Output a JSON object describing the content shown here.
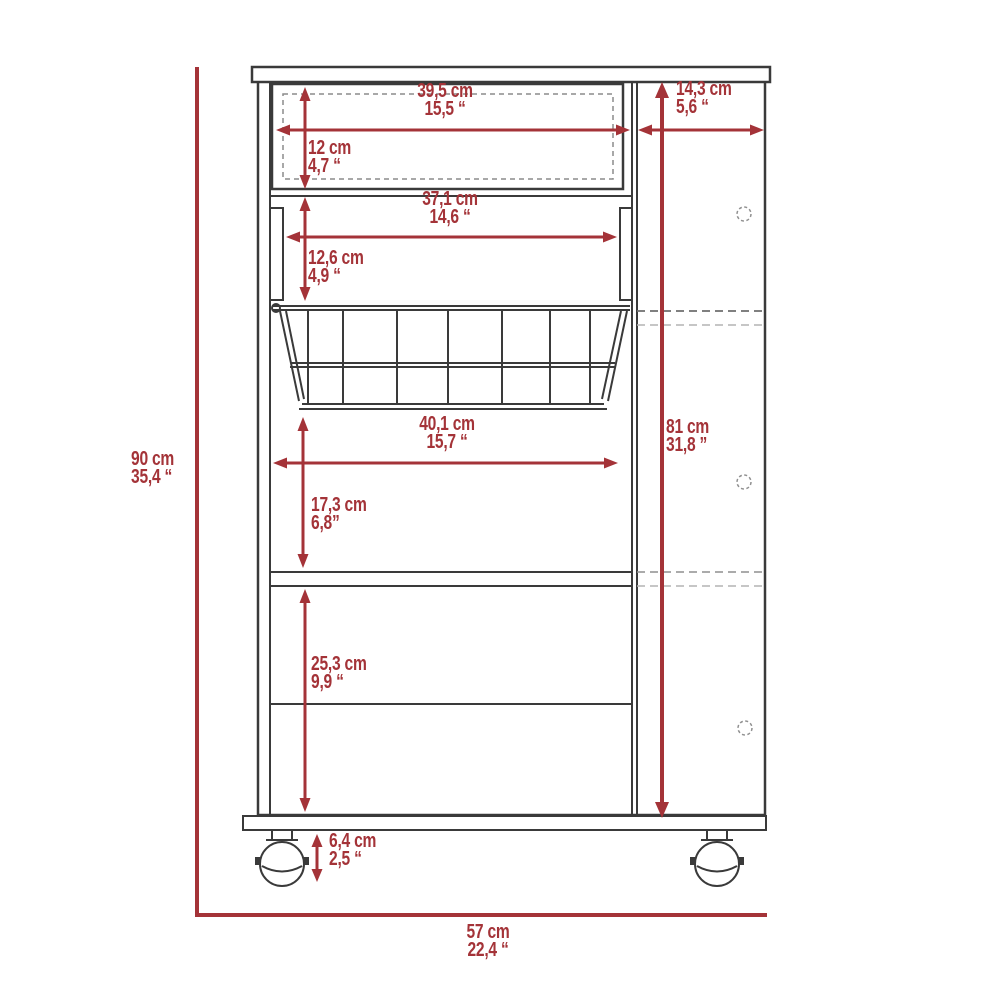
{
  "diagram": {
    "type": "furniture dimension drawing",
    "subject": "cabinet front elevation with pull-out wire basket, drawer, shelves and ball casters",
    "units": [
      "cm",
      "inches"
    ]
  },
  "dimensions": {
    "top_drawer_width": {
      "metric": "39,5 cm",
      "imperial": "15,5 “"
    },
    "top_drawer_height": {
      "metric": "12 cm",
      "imperial": "4,7 “"
    },
    "right_panel_width": {
      "metric": "14,3 cm",
      "imperial": "5,6 “"
    },
    "basket_opening_width": {
      "metric": "37,1 cm",
      "imperial": "14,6 “"
    },
    "basket_opening_height": {
      "metric": "12,6 cm",
      "imperial": "4,9 “"
    },
    "middle_section_width": {
      "metric": "40,1 cm",
      "imperial": "15,7 “"
    },
    "middle_section_height": {
      "metric": "17,3 cm",
      "imperial": "6,8”"
    },
    "lower_section_height": {
      "metric": "25,3 cm",
      "imperial": "9,9 “"
    },
    "caster_height": {
      "metric": "6,4 cm",
      "imperial": "2,5 “"
    },
    "overall_height": {
      "metric": "90 cm",
      "imperial": "35,4 “"
    },
    "interior_side_height": {
      "metric": "81 cm",
      "imperial": "31,8 ”"
    },
    "overall_width": {
      "metric": "57 cm",
      "imperial": "22,4 “"
    }
  },
  "colors": {
    "dimension_red": "#a43338",
    "outline_dark": "#3a3a3a",
    "dashed_gray": "#8f8f8f",
    "background": "#ffffff"
  }
}
